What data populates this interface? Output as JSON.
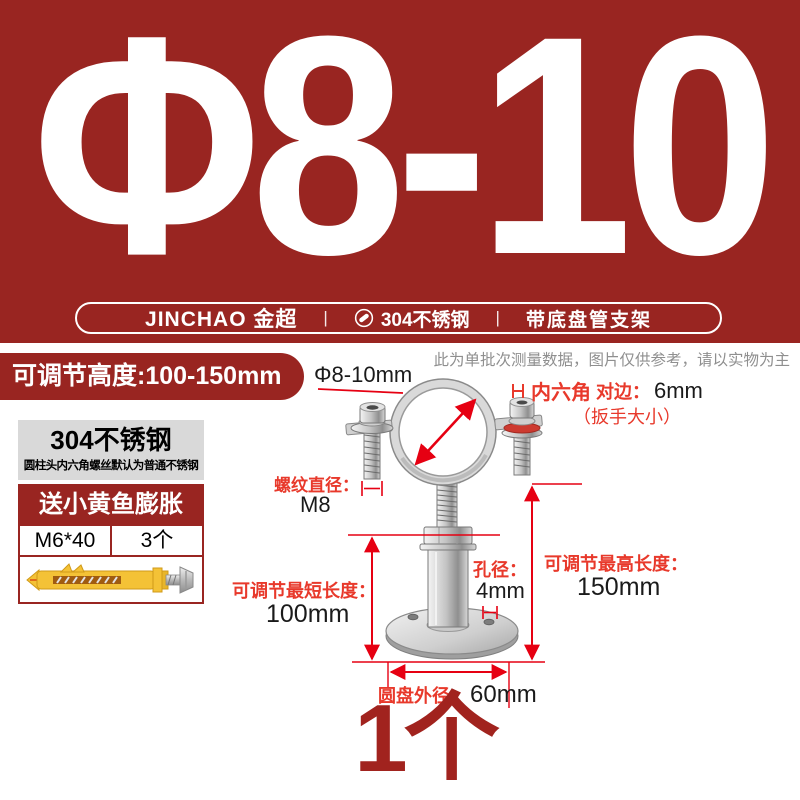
{
  "theme": {
    "brand_red": "#992521",
    "annotation_red": "#e8392b",
    "dimension_line_red": "#e60012",
    "quantity_red": "#a1231e",
    "gray_text": "#8f8f8f",
    "card_gray": "#d9d9d9"
  },
  "hero": {
    "size_label": "Φ8-10"
  },
  "banner": {
    "brand": "JINCHAO 金超",
    "divider": "|",
    "icon": "screw-icon",
    "material": "304不锈钢",
    "product_type": "带底盘管支架"
  },
  "badges": {
    "adjustable_height": "可调节高度:100-150mm"
  },
  "disclaimer": "此为单批次测量数据，图片仅供参考，请以实物为主",
  "info_card": {
    "material_title": "304不锈钢",
    "material_note": "圆柱头内六角螺丝默认为普通不锈钢",
    "gift_title": "送小黄鱼膨胀",
    "spec": "M6*40",
    "qty": "3个",
    "image": "yellow-anchor-image"
  },
  "annotations": {
    "pipe_diameter": "Φ8-10mm",
    "hex_label": "内六角",
    "hex_side": "对边：",
    "hex_value": "6mm",
    "hex_note": "（扳手大小）",
    "thread_label": "螺纹直径：",
    "thread_value": "M8",
    "min_label": "可调节最短长度：",
    "min_value": "100mm",
    "hole_label": "孔径：",
    "hole_value": "4mm",
    "max_label": "可调节最高长度：",
    "max_value": "150mm",
    "disc_label": "圆盘外径：",
    "disc_value": "60mm"
  },
  "quantity": "1个"
}
